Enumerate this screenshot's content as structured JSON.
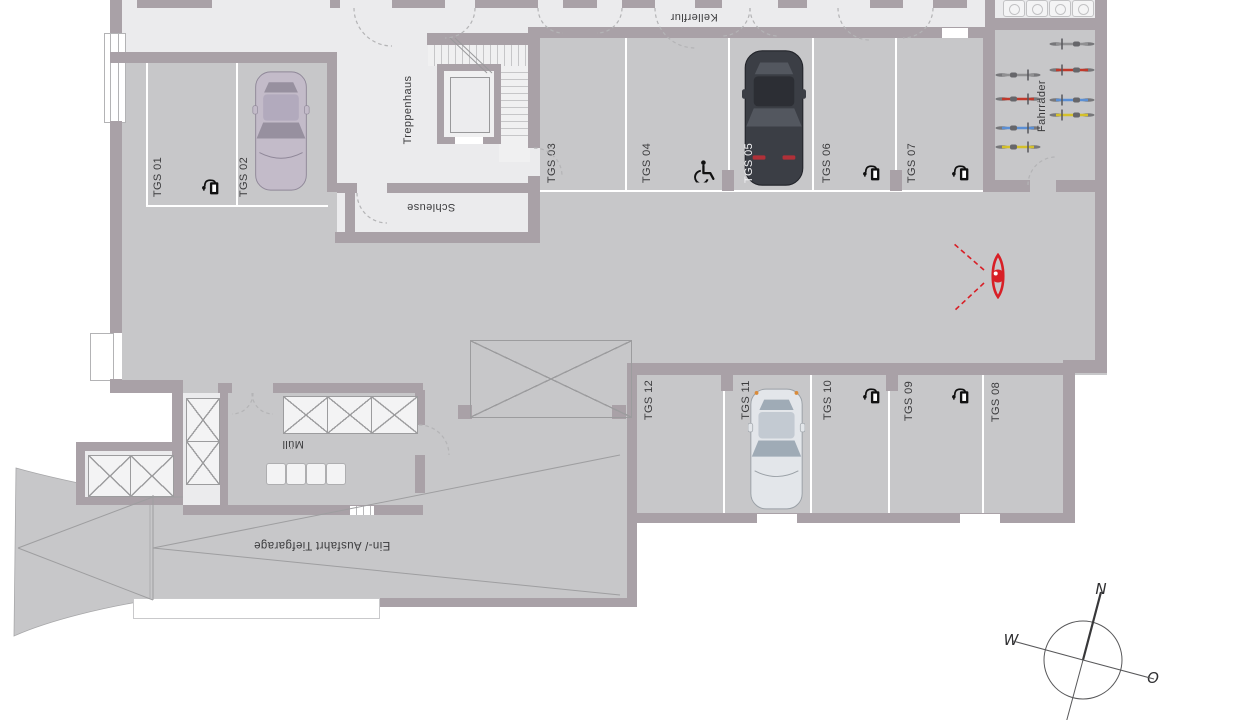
{
  "plan_title": "Tiefgarage Grundriss",
  "rooms": {
    "kellerflur": "Kellerflur",
    "treppenhaus": "Treppenhaus",
    "schleuse": "Schleuse",
    "bike_room": "Fahrräder",
    "waste_room": "Müll",
    "ramp": "Ein-/ Ausfahrt Tiefgarage"
  },
  "parking": {
    "spots": [
      {
        "label": "TGS 01",
        "feature": "ev-charger"
      },
      {
        "label": "TGS 02",
        "feature": "parked-car"
      },
      {
        "label": "TGS 03",
        "feature": ""
      },
      {
        "label": "TGS 04",
        "feature": "wheelchair-accessible"
      },
      {
        "label": "TGS 05",
        "feature": "parked-car"
      },
      {
        "label": "TGS 06",
        "feature": "ev-charger"
      },
      {
        "label": "TGS 07",
        "feature": "ev-charger"
      },
      {
        "label": "TGS 08",
        "feature": ""
      },
      {
        "label": "TGS 09",
        "feature": "ev-charger"
      },
      {
        "label": "TGS 10",
        "feature": "ev-charger"
      },
      {
        "label": "TGS 11",
        "feature": "parked-car"
      },
      {
        "label": "TGS 12",
        "feature": ""
      }
    ]
  },
  "compass": {
    "north": "N",
    "west": "W",
    "east": "O"
  },
  "colors": {
    "wall": "#a9a1a7",
    "floor": "#c7c7c9",
    "room": "#ebebed",
    "line_thin": "#9c9c9e",
    "white_line": "#ffffff",
    "text": "#3b3b3d",
    "accent_red": "#d81f26",
    "bike_gray": "#909092",
    "bike_red": "#c0392b",
    "bike_blue": "#5b8fd4",
    "bike_yellow": "#d4c02a",
    "car_silver_body": "#c3bbc9",
    "car_silver_glass": "#97909f",
    "car_dark_body": "#3b3e45",
    "car_dark_glass": "#53575f",
    "car_white_body": "#e3e6ea",
    "car_white_glass": "#9fabb6"
  }
}
